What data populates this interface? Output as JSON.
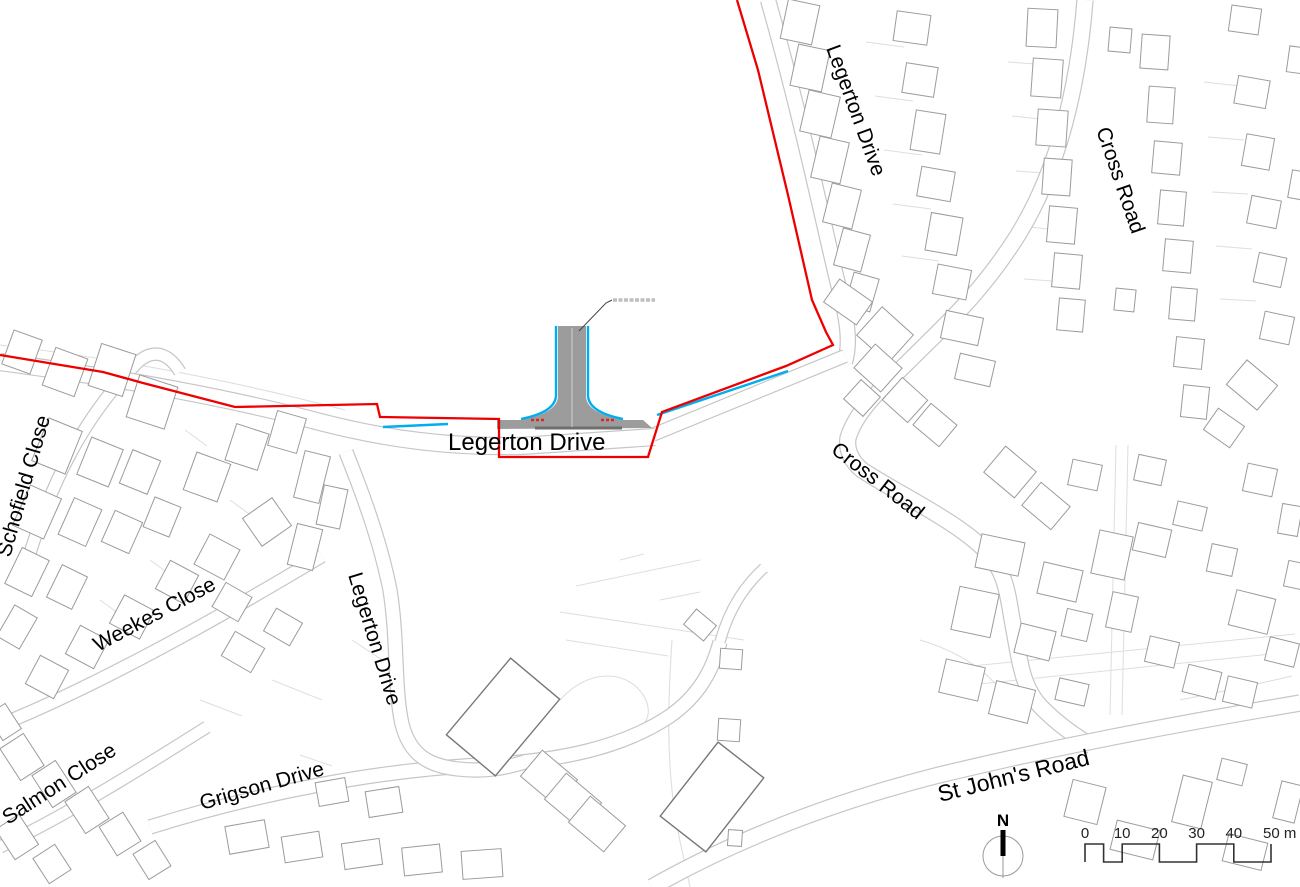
{
  "title": "Site location plan",
  "colors": {
    "boundary": "#ee0000",
    "water_edge": "#00aeef",
    "road_edge": "#c6c6c6",
    "road_edge_dark": "#9a9a9a",
    "parcel": "#dedede",
    "building": "#9b9b9b",
    "building_dark": "#777777",
    "road_fill": "#9c9c9c",
    "kerb": "#6f6f6f",
    "label": "#000000",
    "leader": "#444444",
    "microtext": "#8a8a8a",
    "scalebar": "#333333"
  },
  "labels": [
    {
      "t": "Schofield Close",
      "x": 10,
      "y": 558,
      "r": -74,
      "s": 21
    },
    {
      "t": "Weekes Close",
      "x": 98,
      "y": 652,
      "r": -28,
      "s": 21
    },
    {
      "t": "Salmon Close",
      "x": 8,
      "y": 825,
      "r": -33,
      "s": 21
    },
    {
      "t": "Grigson Drive",
      "x": 202,
      "y": 810,
      "r": -16,
      "s": 21
    },
    {
      "t": "Legerton Drive",
      "x": 348,
      "y": 575,
      "r": 73,
      "s": 21
    },
    {
      "t": "Legerton Drive",
      "x": 448,
      "y": 450,
      "r": 0,
      "s": 24
    },
    {
      "t": "Legerton Drive",
      "x": 826,
      "y": 48,
      "r": 70,
      "s": 21
    },
    {
      "t": "Cross Road",
      "x": 1096,
      "y": 130,
      "r": 71,
      "s": 21
    },
    {
      "t": "Cross Road",
      "x": 830,
      "y": 452,
      "r": 38,
      "s": 21
    },
    {
      "t": "St John's Road",
      "x": 940,
      "y": 802,
      "r": -14,
      "s": 23
    }
  ],
  "boundary_red": [
    [
      737,
      0
    ],
    [
      758,
      70
    ],
    [
      788,
      195
    ],
    [
      812,
      300
    ],
    [
      826,
      332
    ],
    [
      833,
      345
    ],
    [
      786,
      366
    ],
    [
      662,
      412
    ],
    [
      648,
      457
    ],
    [
      499,
      457
    ],
    [
      499,
      419
    ],
    [
      380,
      417
    ],
    [
      377,
      404
    ],
    [
      235,
      407
    ],
    [
      143,
      383
    ],
    [
      103,
      372
    ],
    [
      0,
      355
    ]
  ],
  "cyan_segments": [
    [
      383,
      427,
      448,
      424
    ],
    [
      657,
      415,
      788,
      371
    ]
  ],
  "junction": {
    "access_fill": "M 497,420 L 520,420 Q 558,413 558,396 L 558,326 L 586,326 L 586,396 Q 586,413 624,420 L 643,420 L 652,428 L 497,429 Z",
    "kerb_line": [
      535,
      428,
      622,
      428
    ],
    "centerline": [
      572,
      328,
      572,
      427
    ],
    "cyan_left": "M 521,419 Q 556,412 556,395 L 556,326",
    "cyan_right": "M 588,326 L 588,395 Q 588,412 623,419",
    "red_ticks": [
      [
        531,
        420,
        546,
        420
      ],
      [
        601,
        420,
        616,
        420
      ]
    ],
    "leader": "M 579,331 L 606,303 L 612,300",
    "microtext_line": [
      613,
      300,
      655,
      300
    ]
  },
  "roads": [
    {
      "name": "schofield-close-road",
      "d": "M 28,560 C 52,478 86,415 136,364 C 152,348 168,352 180,372",
      "w": 11
    },
    {
      "name": "weekes-close-road",
      "d": "M 0,725 C 92,688 205,626 322,556",
      "w": 12
    },
    {
      "name": "salmon-close-road",
      "d": "M 0,847 C 72,812 142,768 207,727",
      "w": 11
    },
    {
      "name": "grigson-drive-road",
      "d": "M 150,827 C 262,792 380,770 482,765 C 560,761 622,748 670,716 C 698,696 712,672 720,642",
      "w": 13
    },
    {
      "name": "grigson-extension",
      "d": "M 720,642 C 728,612 742,588 764,568",
      "w": 9
    },
    {
      "name": "legerton-drive-south-road",
      "d": "M 346,452 C 362,492 380,540 390,590 C 398,640 394,688 402,724 C 410,756 430,766 458,769 C 485,772 505,768 525,762",
      "w": 13
    },
    {
      "name": "cross-road",
      "d": "M 1085,0 C 1078,90 1058,170 1018,235 C 980,295 945,325 908,362 C 872,397 855,415 848,438 C 846,450 852,462 862,470 C 900,495 955,520 985,550 C 1008,573 1008,600 1014,630 C 1020,662 1022,688 1042,708 C 1060,726 1078,738 1092,746",
      "w": 15
    },
    {
      "name": "st-johns-road",
      "d": "M 652,887 C 735,840 830,803 935,776 C 1050,748 1165,726 1300,703",
      "w": 15
    },
    {
      "name": "legerton-drive-north-road",
      "d": "M 845,362 C 850,345 848,325 842,300 C 830,255 805,130 768,0",
      "w": 14
    },
    {
      "name": "legerton-drive-link-lane",
      "d": "M 640,440 L 845,356",
      "w": 12
    },
    {
      "name": "legerton-drive-main-road",
      "d": "M 0,362 C 120,378 230,398 320,422 C 390,440 450,447 520,446 L 655,437",
      "w": 16
    }
  ],
  "parcel_lines": [
    [
      866,
      42,
      904,
      47
    ],
    [
      875,
      96,
      913,
      101
    ],
    [
      884,
      150,
      922,
      155
    ],
    [
      893,
      204,
      931,
      209
    ],
    [
      902,
      256,
      939,
      261
    ],
    [
      1008,
      62,
      1036,
      64
    ],
    [
      1012,
      116,
      1040,
      119
    ],
    [
      1016,
      171,
      1044,
      173
    ],
    [
      1020,
      226,
      1048,
      229
    ],
    [
      1024,
      279,
      1052,
      281
    ],
    [
      1204,
      82,
      1240,
      86
    ],
    [
      1208,
      137,
      1244,
      140
    ],
    [
      1212,
      192,
      1248,
      194
    ],
    [
      1216,
      246,
      1252,
      249
    ],
    [
      1220,
      299,
      1256,
      301
    ],
    [
      1116,
      445,
      1110,
      715
    ],
    [
      1128,
      445,
      1122,
      715
    ],
    [
      940,
      688,
      1290,
      652
    ],
    [
      952,
      668,
      1295,
      634
    ],
    [
      185,
      430,
      207,
      446
    ],
    [
      230,
      500,
      252,
      516
    ],
    [
      150,
      560,
      172,
      576
    ],
    [
      100,
      600,
      122,
      616
    ],
    [
      272,
      680,
      322,
      700
    ],
    [
      352,
      640,
      382,
      660
    ],
    [
      300,
      755,
      332,
      766
    ],
    [
      200,
      700,
      242,
      716
    ],
    [
      560,
      612,
      744,
      640
    ],
    [
      566,
      640,
      668,
      656
    ],
    [
      576,
      586,
      700,
      560
    ],
    [
      660,
      600,
      700,
      592
    ],
    [
      620,
      560,
      644,
      554
    ]
  ],
  "faint_paths": [
    "M 0,345 C 130,360 250,385 345,410",
    "M 560,700 C 588,668 630,668 646,700 C 652,716 646,727 630,731",
    "M 672,640 C 668,700 666,760 676,820 C 680,845 686,866 690,887",
    "M 920,640 C 960,652 990,672 1008,700",
    "M 1180,700 C 1220,692 1258,684 1292,676"
  ],
  "buildings": [
    [
      800,
      22,
      32,
      40,
      12
    ],
    [
      810,
      68,
      32,
      42,
      12
    ],
    [
      820,
      114,
      32,
      42,
      13
    ],
    [
      830,
      160,
      30,
      42,
      13
    ],
    [
      842,
      206,
      30,
      40,
      14
    ],
    [
      852,
      250,
      28,
      38,
      15
    ],
    [
      862,
      292,
      26,
      34,
      16
    ],
    [
      912,
      28,
      34,
      30,
      8
    ],
    [
      920,
      80,
      32,
      30,
      9
    ],
    [
      928,
      132,
      30,
      40,
      9
    ],
    [
      936,
      184,
      34,
      30,
      10
    ],
    [
      944,
      234,
      32,
      38,
      10
    ],
    [
      952,
      282,
      34,
      30,
      11
    ],
    [
      962,
      328,
      38,
      28,
      12
    ],
    [
      975,
      370,
      36,
      26,
      13
    ],
    [
      848,
      302,
      40,
      28,
      35
    ],
    [
      885,
      335,
      42,
      38,
      42
    ],
    [
      878,
      368,
      36,
      32,
      42
    ],
    [
      905,
      400,
      34,
      30,
      42
    ],
    [
      862,
      398,
      26,
      26,
      42
    ],
    [
      935,
      425,
      34,
      28,
      40
    ],
    [
      1042,
      28,
      30,
      38,
      3
    ],
    [
      1047,
      78,
      30,
      38,
      4
    ],
    [
      1052,
      128,
      30,
      36,
      4
    ],
    [
      1057,
      177,
      28,
      36,
      4
    ],
    [
      1062,
      225,
      28,
      36,
      5
    ],
    [
      1067,
      271,
      28,
      34,
      5
    ],
    [
      1071,
      315,
      26,
      32,
      5
    ],
    [
      1120,
      40,
      22,
      24,
      5
    ],
    [
      1125,
      300,
      20,
      22,
      6
    ],
    [
      1155,
      52,
      28,
      34,
      4
    ],
    [
      1161,
      105,
      26,
      36,
      4
    ],
    [
      1167,
      158,
      28,
      32,
      5
    ],
    [
      1172,
      208,
      26,
      34,
      5
    ],
    [
      1178,
      256,
      28,
      32,
      5
    ],
    [
      1183,
      304,
      26,
      32,
      5
    ],
    [
      1189,
      353,
      28,
      30,
      6
    ],
    [
      1195,
      402,
      26,
      32,
      6
    ],
    [
      1245,
      20,
      30,
      26,
      8
    ],
    [
      1252,
      92,
      32,
      28,
      10
    ],
    [
      1258,
      152,
      28,
      32,
      10
    ],
    [
      1264,
      212,
      30,
      28,
      11
    ],
    [
      1270,
      270,
      28,
      30,
      12
    ],
    [
      1277,
      328,
      30,
      28,
      12
    ],
    [
      1252,
      385,
      40,
      32,
      40
    ],
    [
      1224,
      428,
      32,
      26,
      35
    ],
    [
      1297,
      60,
      18,
      26,
      8
    ],
    [
      1298,
      185,
      16,
      28,
      10
    ],
    [
      1010,
      472,
      40,
      34,
      40
    ],
    [
      1046,
      506,
      38,
      30,
      40
    ],
    [
      1085,
      475,
      30,
      26,
      12
    ],
    [
      1150,
      470,
      28,
      26,
      12
    ],
    [
      1260,
      480,
      30,
      28,
      12
    ],
    [
      1290,
      520,
      20,
      30,
      10
    ],
    [
      1000,
      555,
      44,
      34,
      12
    ],
    [
      1060,
      582,
      40,
      32,
      13
    ],
    [
      1112,
      555,
      34,
      44,
      12
    ],
    [
      975,
      612,
      40,
      44,
      12
    ],
    [
      1035,
      642,
      36,
      30,
      14
    ],
    [
      1077,
      625,
      26,
      28,
      13
    ],
    [
      1122,
      612,
      26,
      36,
      12
    ],
    [
      1152,
      540,
      34,
      28,
      13
    ],
    [
      1190,
      516,
      30,
      24,
      13
    ],
    [
      1222,
      560,
      26,
      28,
      12
    ],
    [
      1252,
      612,
      40,
      36,
      14
    ],
    [
      1282,
      652,
      30,
      24,
      14
    ],
    [
      1162,
      652,
      30,
      26,
      13
    ],
    [
      1202,
      682,
      34,
      28,
      14
    ],
    [
      962,
      680,
      40,
      34,
      13
    ],
    [
      1012,
      702,
      40,
      34,
      14
    ],
    [
      1072,
      692,
      30,
      22,
      13
    ],
    [
      1240,
      692,
      30,
      26,
      13
    ],
    [
      1295,
      575,
      18,
      26,
      12
    ],
    [
      1085,
      802,
      34,
      38,
      14
    ],
    [
      1135,
      840,
      44,
      30,
      14
    ],
    [
      1192,
      802,
      30,
      48,
      14
    ],
    [
      1245,
      852,
      40,
      28,
      14
    ],
    [
      1288,
      802,
      22,
      38,
      14
    ],
    [
      1232,
      772,
      26,
      22,
      14
    ],
    [
      503,
      717,
      64,
      100,
      40,
      1
    ],
    [
      549,
      778,
      46,
      34,
      40
    ],
    [
      573,
      801,
      46,
      34,
      40
    ],
    [
      597,
      824,
      46,
      34,
      40
    ],
    [
      712,
      797,
      58,
      94,
      38,
      1
    ],
    [
      731,
      659,
      22,
      20,
      4
    ],
    [
      729,
      730,
      22,
      22,
      4
    ],
    [
      735,
      838,
      14,
      16,
      4
    ],
    [
      700,
      625,
      26,
      20,
      40
    ],
    [
      22,
      352,
      30,
      36,
      20
    ],
    [
      65,
      372,
      34,
      40,
      20
    ],
    [
      112,
      370,
      36,
      44,
      18
    ],
    [
      152,
      402,
      40,
      44,
      18
    ],
    [
      57,
      446,
      36,
      46,
      22
    ],
    [
      100,
      462,
      34,
      40,
      22
    ],
    [
      140,
      472,
      30,
      36,
      22
    ],
    [
      37,
      512,
      34,
      44,
      24
    ],
    [
      80,
      522,
      30,
      40,
      24
    ],
    [
      122,
      532,
      30,
      34,
      24
    ],
    [
      162,
      517,
      28,
      32,
      22
    ],
    [
      27,
      572,
      30,
      40,
      26
    ],
    [
      67,
      587,
      28,
      36,
      26
    ],
    [
      207,
      477,
      36,
      40,
      20
    ],
    [
      247,
      447,
      34,
      38,
      18
    ],
    [
      287,
      432,
      30,
      36,
      16
    ],
    [
      312,
      477,
      26,
      48,
      14
    ],
    [
      267,
      522,
      34,
      36,
      55
    ],
    [
      217,
      557,
      34,
      34,
      28
    ],
    [
      177,
      582,
      32,
      32,
      28
    ],
    [
      132,
      617,
      34,
      32,
      28
    ],
    [
      87,
      647,
      32,
      32,
      28
    ],
    [
      47,
      677,
      32,
      32,
      28
    ],
    [
      232,
      602,
      30,
      28,
      30
    ],
    [
      305,
      547,
      26,
      42,
      14
    ],
    [
      332,
      507,
      24,
      40,
      12
    ],
    [
      17,
      627,
      26,
      36,
      30
    ],
    [
      243,
      652,
      34,
      28,
      30
    ],
    [
      283,
      627,
      30,
      26,
      30
    ],
    [
      22,
      757,
      28,
      38,
      -33
    ],
    [
      54,
      784,
      28,
      38,
      -33
    ],
    [
      87,
      810,
      28,
      38,
      -33
    ],
    [
      17,
      837,
      28,
      36,
      -33
    ],
    [
      120,
      834,
      28,
      34,
      -32
    ],
    [
      152,
      860,
      26,
      30,
      -32
    ],
    [
      52,
      864,
      26,
      30,
      -33
    ],
    [
      4,
      722,
      22,
      30,
      -33
    ],
    [
      247,
      837,
      40,
      28,
      -10
    ],
    [
      302,
      847,
      38,
      26,
      -9
    ],
    [
      362,
      854,
      38,
      26,
      -8
    ],
    [
      422,
      860,
      38,
      28,
      -6
    ],
    [
      332,
      792,
      30,
      24,
      -10
    ],
    [
      384,
      802,
      34,
      26,
      -9
    ],
    [
      482,
      864,
      40,
      28,
      -4
    ]
  ],
  "north_arrow": {
    "label": "N",
    "cx": 1003,
    "cy": 856,
    "r": 20
  },
  "scalebar": {
    "x0": 1085,
    "px_per_m": 3.72,
    "y_top": 844,
    "y_bottom": 862,
    "label_y": 838,
    "pattern": [
      [
        0,
        5,
        "top"
      ],
      [
        5,
        10,
        "bottom"
      ],
      [
        10,
        20,
        "top"
      ],
      [
        20,
        30,
        "bottom"
      ],
      [
        30,
        40,
        "top"
      ],
      [
        40,
        50,
        "bottom"
      ]
    ],
    "labels": [
      {
        "t": "0",
        "m": 0
      },
      {
        "t": "10",
        "m": 10
      },
      {
        "t": "20",
        "m": 20
      },
      {
        "t": "30",
        "m": 30
      },
      {
        "t": "40",
        "m": 40
      },
      {
        "t": "50 m",
        "m": 50
      }
    ]
  }
}
